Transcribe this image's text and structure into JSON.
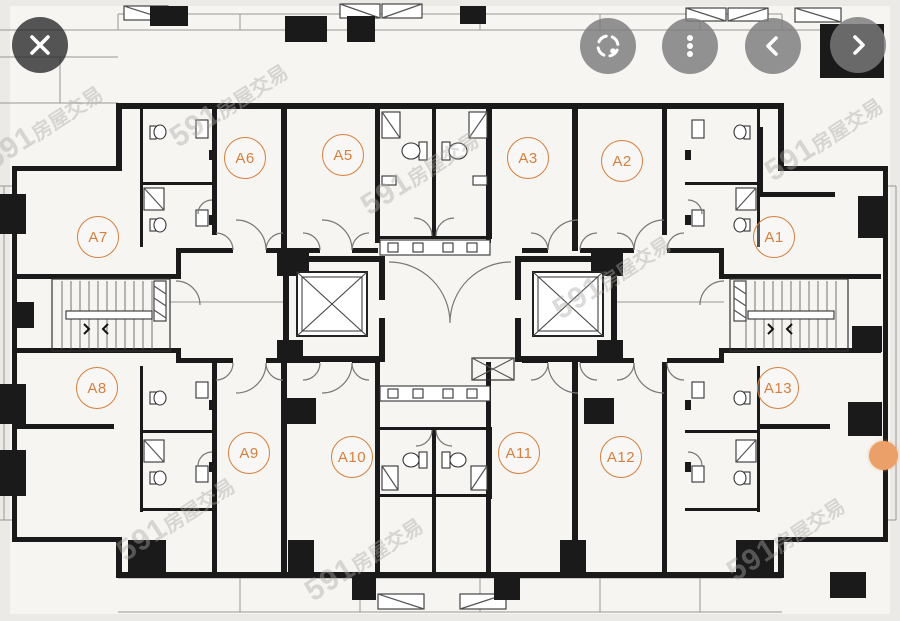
{
  "app": {
    "view": "floor-plan-image-viewer"
  },
  "toolbar": {
    "close_icon": "✕",
    "scan_icon": "focus-scan",
    "more_icon": "⋮",
    "prev_icon": "‹",
    "next_icon": "›"
  },
  "floor_plan": {
    "units": [
      {
        "id": "A6"
      },
      {
        "id": "A5"
      },
      {
        "id": "A3"
      },
      {
        "id": "A2"
      },
      {
        "id": "A7"
      },
      {
        "id": "A1"
      },
      {
        "id": "A8"
      },
      {
        "id": "A13"
      },
      {
        "id": "A9"
      },
      {
        "id": "A10"
      },
      {
        "id": "A11"
      },
      {
        "id": "A12"
      }
    ]
  },
  "watermark": {
    "brand": "591",
    "suffix": "房屋交易"
  },
  "page_indicator": {
    "shape": "dot",
    "color": "#ECA069"
  },
  "colors": {
    "accent_orange": "#D67F3E",
    "wall_black": "#1A1A1A",
    "floor": "#F6F5F2",
    "background": "#ECEAE7",
    "button_gray": "rgba(123,123,123,0.82)",
    "close_button_gray": "rgba(44,44,44,0.80)"
  }
}
